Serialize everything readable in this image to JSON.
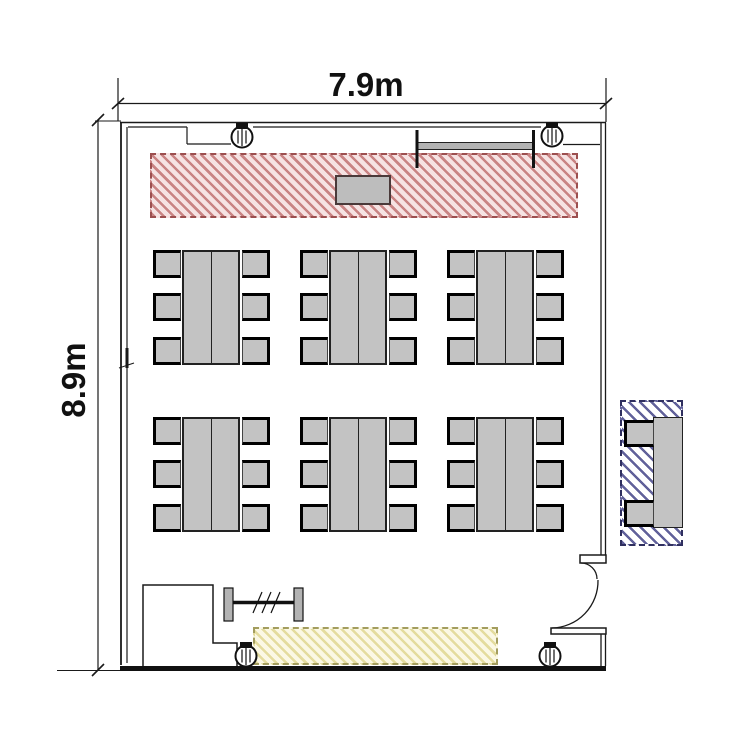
{
  "floor_plan": {
    "dimension_labels": {
      "width": "7.9m",
      "height": "8.9m"
    },
    "colors": {
      "wall": "#1a1a1a",
      "furniture_fill": "#c3c3c3",
      "front_zone_hatch": "#c98484",
      "front_zone_border": "#9c4f4f",
      "side_zone_hatch": "#61619a",
      "side_zone_border": "#2f2f5f",
      "back_zone_hatch": "#e4dc9e",
      "back_zone_border": "#a39d5e"
    },
    "furniture_counts": {
      "table_groups": 6,
      "chairs_per_table_group": 6,
      "side_tables": 1,
      "side_table_chairs": 2,
      "columns": 4,
      "podiums": 1,
      "wall_boards": 1
    },
    "icons": {
      "column": "circle-with-vertical-hatch",
      "door": "quarter-arc-swing",
      "rack": "bar-with-end-plates"
    }
  }
}
